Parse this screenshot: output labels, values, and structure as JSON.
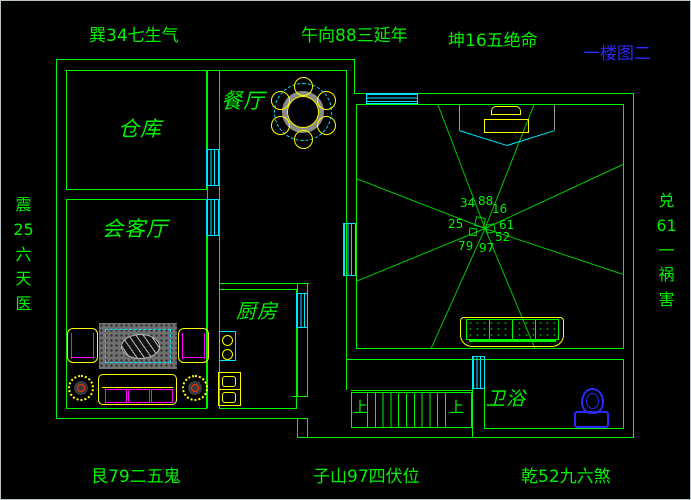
{
  "sheet": {
    "label": "一楼图二",
    "color": "#2a2aff"
  },
  "compass": {
    "top_left": "巽34七生气",
    "top_center": "午向88三延年",
    "top_right": "坤16五绝命",
    "left": "震25六天医",
    "right": "兑61一祸害",
    "bottom_left": "艮79二五鬼",
    "bottom_center": "子山97四伏位",
    "bottom_right": "乾52九六煞"
  },
  "rooms": {
    "warehouse": "仓库",
    "dining": "餐厅",
    "living": "会客厅",
    "kitchen": "厨房",
    "bathroom": "卫浴"
  },
  "stairs": {
    "up": "上"
  },
  "fengshui_numbers": [
    "34",
    "88",
    "16",
    "25",
    "61",
    "52",
    "79",
    "97"
  ],
  "colors": {
    "background": "#000000",
    "wall": "#00f400",
    "window": "#00e5ff",
    "furniture": "#ffff00",
    "sofa_accent": "#ff00ff",
    "fixture_blue": "#2a2aff",
    "table_ring": "#8a8a8a",
    "sheet_label": "#2a2aff"
  }
}
